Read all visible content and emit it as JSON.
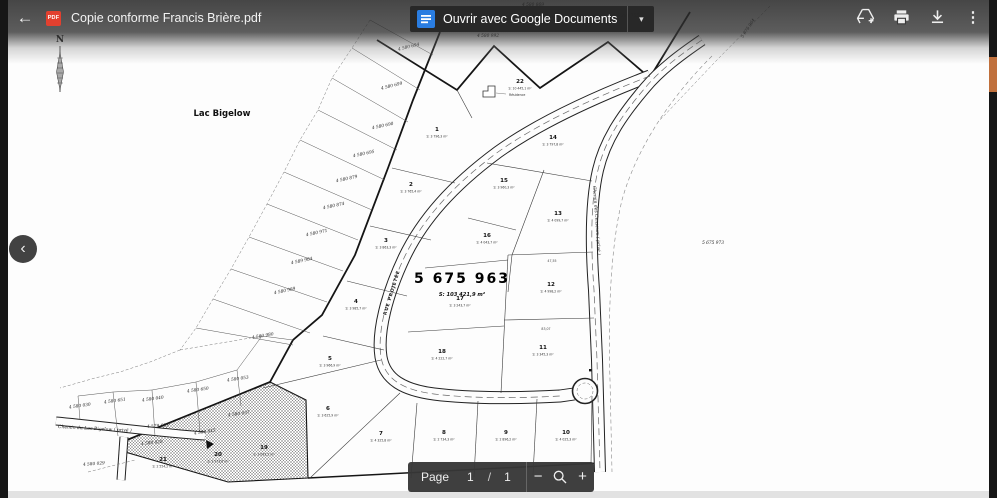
{
  "colors": {
    "pdf_red": "#e2402f",
    "docs_blue": "#2a7de1",
    "scroll_thumb": "#c0703c",
    "toolbar_text": "#f1f1f1"
  },
  "icons": {
    "back": "←",
    "caret": "▾",
    "more": "⋮",
    "minus": "−",
    "plus": "+",
    "chevron_left": "‹"
  },
  "toolbar": {
    "title": "Copie conforme Francis Brière.pdf",
    "pdf_badge": "PDF",
    "open_with": "Ouvrir avec Google Documents"
  },
  "pager": {
    "page_label": "Page",
    "current": "1",
    "sep": "/",
    "total": "1"
  },
  "map": {
    "lake_label": {
      "t": "Lac Bigelow",
      "x": 222,
      "y": 116
    },
    "north_label": {
      "t": "N",
      "x": 60,
      "y": 42
    },
    "main_lot": {
      "number": "5 675 963",
      "area": "S: 103 421,9 m²",
      "x": 462,
      "y": 283
    },
    "residence": {
      "t": "Résidence",
      "x": 509,
      "y": 96
    },
    "road_labels": [
      {
        "t": "RUE PROJETÉE",
        "x": 393,
        "y": 293,
        "rot": -73,
        "cls": "roadlbl"
      },
      {
        "t": "Chemin des Censeurs ( privé )",
        "x": 593,
        "y": 186,
        "rot": 86,
        "cls": "roadlbl2"
      },
      {
        "t": "Chemin du Lac-Bigelow ( privé )",
        "x": 58,
        "y": 428,
        "rot": 3,
        "cls": "roadlbl2"
      }
    ],
    "lots": [
      {
        "n": "1",
        "area": "S: 3 796,3 m²",
        "x": 437,
        "y": 131
      },
      {
        "n": "2",
        "area": "S: 3 765,4 m²",
        "x": 411,
        "y": 186
      },
      {
        "n": "3",
        "area": "S: 3 863,3 m²",
        "x": 386,
        "y": 242
      },
      {
        "n": "4",
        "area": "S: 3 985,7 m²",
        "x": 356,
        "y": 303
      },
      {
        "n": "5",
        "area": "S: 3 966,9 m²",
        "x": 330,
        "y": 360
      },
      {
        "n": "6",
        "area": "S: 3 625,9 m²",
        "x": 328,
        "y": 410
      },
      {
        "n": "7",
        "area": "S: 4 325,8 m²",
        "x": 381,
        "y": 435
      },
      {
        "n": "8",
        "area": "S: 2 734,3 m²",
        "x": 444,
        "y": 434
      },
      {
        "n": "9",
        "area": "S: 2 896,2 m²",
        "x": 506,
        "y": 434
      },
      {
        "n": "10",
        "area": "S: 4 025,3 m²",
        "x": 566,
        "y": 434
      },
      {
        "n": "11",
        "area": "S: 3 345,3 m²",
        "x": 543,
        "y": 349
      },
      {
        "n": "12",
        "area": "S: 4 998,2 m²",
        "x": 551,
        "y": 286
      },
      {
        "n": "13",
        "area": "S: 4 099,7 m²",
        "x": 558,
        "y": 215
      },
      {
        "n": "14",
        "area": "S: 3 797,8 m²",
        "x": 553,
        "y": 139
      },
      {
        "n": "15",
        "area": "S: 3 960,3 m²",
        "x": 504,
        "y": 182
      },
      {
        "n": "16",
        "area": "S: 4 043,7 m²",
        "x": 487,
        "y": 237
      },
      {
        "n": "17",
        "area": "S: 3 243,7 m²",
        "x": 460,
        "y": 300
      },
      {
        "n": "18",
        "area": "S: 4 222,7 m²",
        "x": 442,
        "y": 353
      },
      {
        "n": "19",
        "area": "S: 3 093,2 m²",
        "x": 264,
        "y": 449
      },
      {
        "n": "20",
        "area": "S: 2 973,6 m²",
        "x": 218,
        "y": 456
      },
      {
        "n": "21",
        "area": "S: 2 554,2 m²",
        "x": 163,
        "y": 461
      },
      {
        "n": "22",
        "area": "S: 10 445,1 m²",
        "x": 520,
        "y": 83
      }
    ],
    "parcel_ids": [
      {
        "t": "4 580 869",
        "x": 533,
        "y": 6,
        "rot": 0
      },
      {
        "t": "4 580 992",
        "x": 488,
        "y": 37,
        "rot": 0
      },
      {
        "t": "5 380 755",
        "x": 628,
        "y": 17,
        "rot": 0
      },
      {
        "t": "5 675 964",
        "x": 749,
        "y": 29,
        "rot": -57
      },
      {
        "t": "5 675 973",
        "x": 713,
        "y": 244,
        "rot": 0
      },
      {
        "t": "4 580 694",
        "x": 409,
        "y": 48,
        "rot": -14
      },
      {
        "t": "4 580 699",
        "x": 392,
        "y": 87,
        "rot": -14
      },
      {
        "t": "4 580 690",
        "x": 383,
        "y": 127,
        "rot": -12
      },
      {
        "t": "4 580 695",
        "x": 364,
        "y": 155,
        "rot": -12
      },
      {
        "t": "4 580 879",
        "x": 347,
        "y": 180,
        "rot": -12
      },
      {
        "t": "4 580 874",
        "x": 334,
        "y": 207,
        "rot": -12
      },
      {
        "t": "4 580 971",
        "x": 317,
        "y": 234,
        "rot": -12
      },
      {
        "t": "4 589 984",
        "x": 302,
        "y": 262,
        "rot": -12
      },
      {
        "t": "4 580 989",
        "x": 285,
        "y": 292,
        "rot": -12
      },
      {
        "t": "4 580 980",
        "x": 263,
        "y": 337,
        "rot": -10
      },
      {
        "t": "4 580 053",
        "x": 238,
        "y": 380,
        "rot": -8
      },
      {
        "t": "4 580 650",
        "x": 198,
        "y": 391,
        "rot": -8
      },
      {
        "t": "4 580 040",
        "x": 153,
        "y": 400,
        "rot": -8
      },
      {
        "t": "4 580 651",
        "x": 115,
        "y": 402,
        "rot": -8
      },
      {
        "t": "4 580 030",
        "x": 80,
        "y": 407,
        "rot": -8
      },
      {
        "t": "4 580 037",
        "x": 239,
        "y": 415,
        "rot": -8
      },
      {
        "t": "4 579 633",
        "x": 158,
        "y": 427,
        "rot": -4
      },
      {
        "t": "4 580 045",
        "x": 205,
        "y": 433,
        "rot": -8
      },
      {
        "t": "4 580 028",
        "x": 152,
        "y": 444,
        "rot": -6
      },
      {
        "t": "4 580 029",
        "x": 94,
        "y": 465,
        "rot": -4
      }
    ],
    "dimensions": [
      {
        "t": "83,07",
        "x": 546,
        "y": 330,
        "rot": 0
      },
      {
        "t": "47,55",
        "x": 552,
        "y": 262,
        "rot": 0
      }
    ]
  }
}
